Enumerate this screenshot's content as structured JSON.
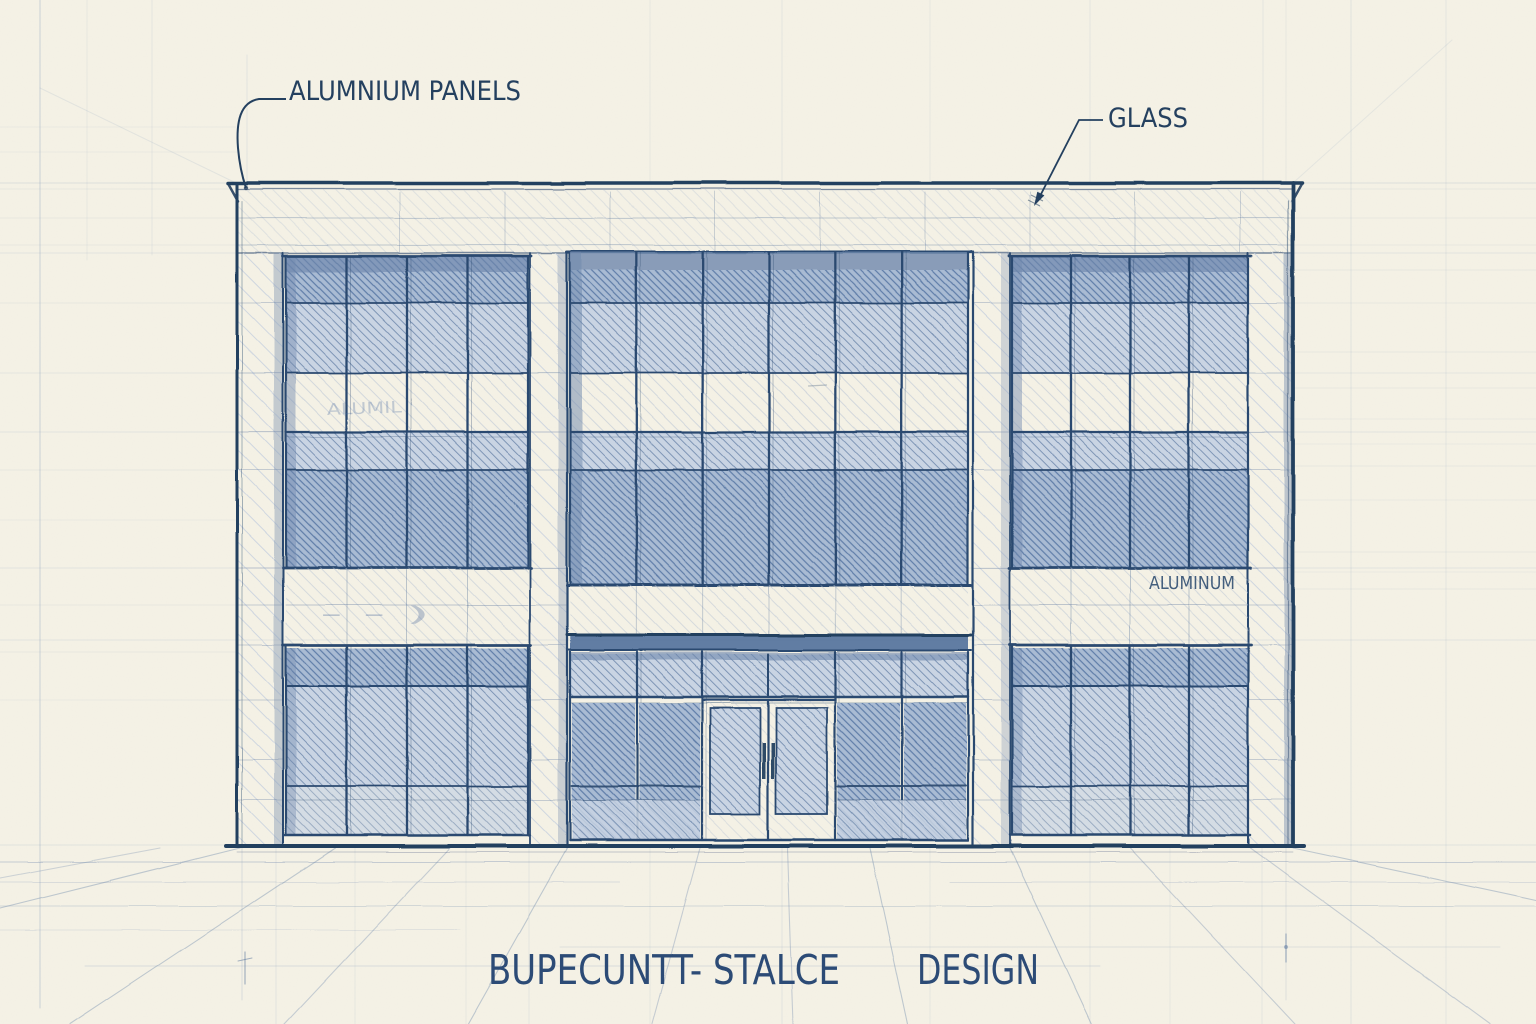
{
  "document": {
    "kind": "architectural facade elevation sketch",
    "title": {
      "part1": "BUPECUNTT- STALCE",
      "part2": "DESIGN"
    }
  },
  "annotations": {
    "panels_label": "ALUMNIUM PANELS",
    "glass_label": "GLASS",
    "spandrel_material_label": "ALUMINUM",
    "window_band_scribble": "ALUMIL",
    "spandrel_scribble": "- - )"
  },
  "facade": {
    "bays": [
      {
        "name": "left",
        "window_columns": 4
      },
      {
        "name": "center",
        "window_columns": 6
      },
      {
        "name": "right",
        "window_columns": 4
      }
    ],
    "floors_visible": 2,
    "entrance": {
      "door_leaves": 2,
      "sidelights": true,
      "transom": true
    }
  },
  "colors": {
    "paper": "#f5f2e6",
    "ink_dark": "#24405f",
    "ink": "#2c4a6f",
    "ink_mid": "#54719b",
    "glass_med_bg": "#c9d4e3",
    "glass_med_line": "#7f96b6",
    "glass_dark_bg": "#a9bbd3",
    "glass_dark_line": "#5f7da8",
    "lite_line": "#b7c3d4",
    "pier_line": "#c6d0de",
    "shadow": "#6e87ac",
    "guide": "#7e97b8",
    "label": "#2c4b76"
  }
}
